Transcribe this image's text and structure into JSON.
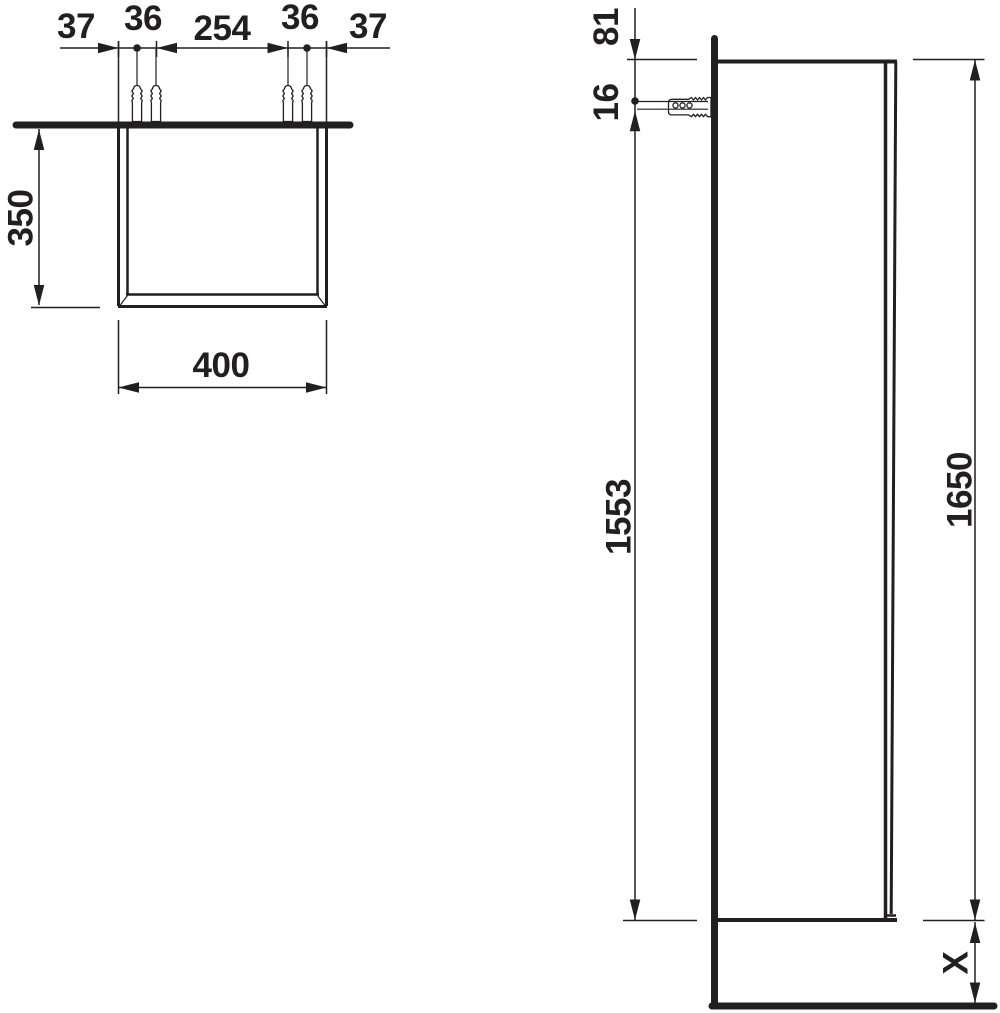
{
  "drawing": {
    "top_view": {
      "dim_left_offset": "37",
      "dim_left_plug_spacing": "36",
      "dim_center_span": "254",
      "dim_right_plug_spacing": "36",
      "dim_right_offset": "37",
      "dim_depth": "350",
      "dim_width": "400"
    },
    "side_view": {
      "dim_top_to_fixing": "81",
      "dim_fixing_offset": "16",
      "dim_fixing_to_bottom": "1553",
      "dim_height": "1650",
      "dim_floor_clearance": "X"
    }
  }
}
